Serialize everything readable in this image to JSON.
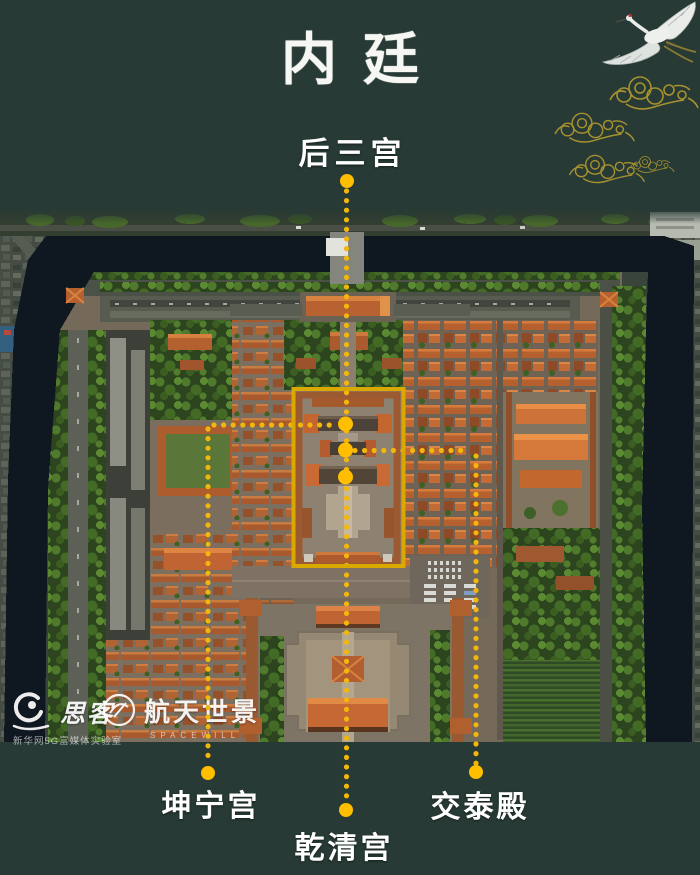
{
  "title": "内廷",
  "callouts": {
    "top": "后三宫",
    "bottom_left": "坤宁宫",
    "bottom_center": "乾清宫",
    "bottom_right": "交泰殿"
  },
  "watermarks": {
    "sike_name": "思客",
    "sike_sub": "新华网5G富媒体实验室",
    "spacewill_name": "航天世景",
    "spacewill_sub": "SPACEWILL"
  },
  "colors": {
    "background": "#273a35",
    "accent_yellow": "#f3b70c",
    "box_yellow": "#d9a900",
    "cloud_gold": "#a8922f",
    "moat_water": "#0f1720",
    "roof_orange": "#b86232"
  }
}
